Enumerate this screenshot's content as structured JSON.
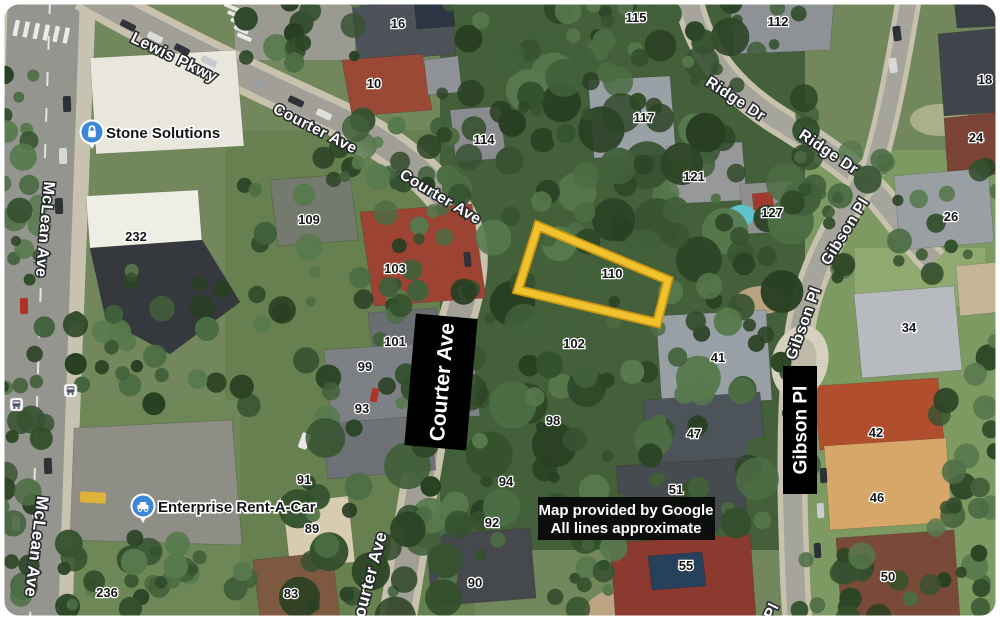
{
  "map": {
    "attribution": {
      "line1": "Map provided by Google",
      "line2": "All lines approximate"
    },
    "businesses": [
      {
        "name": "Stone Solutions",
        "icon": "lock-pin-icon"
      },
      {
        "name": "Enterprise Rent-A-Car",
        "icon": "car-pin-icon"
      }
    ],
    "overlay_boxes": [
      {
        "text": "Courter Ave"
      },
      {
        "text": "Gibson Pl"
      }
    ],
    "parcel": {
      "label": "110",
      "outline_color": "#F0C22E"
    },
    "icons": [
      "lock-pin-icon",
      "car-pin-icon",
      "bus-stop-icon",
      "bus-stop-icon"
    ],
    "colors": {
      "parcel_outline": "#F0C22E",
      "pin_blue": "#3D87D6",
      "annotation_bg": "#000000"
    },
    "street_labels": [
      {
        "t": "Lewis Pkwy",
        "x": 172,
        "y": 62,
        "r": 26,
        "s": 16
      },
      {
        "t": "Courter Ave",
        "x": 313,
        "y": 133,
        "r": 27,
        "s": 15.5
      },
      {
        "t": "Courter Ave",
        "x": 438,
        "y": 201,
        "r": 31,
        "s": 15.5
      },
      {
        "t": "Courter Ave",
        "x": 374,
        "y": 582,
        "r": -75,
        "s": 17
      },
      {
        "t": "McLean Ave",
        "x": 40,
        "y": 229,
        "r": 95,
        "s": 16
      },
      {
        "t": "McLean Ave",
        "x": 31,
        "y": 546,
        "r": 97,
        "s": 17
      },
      {
        "t": "Ridge Dr",
        "x": 733,
        "y": 103,
        "r": 33,
        "s": 15.5
      },
      {
        "t": "Ridge Dr",
        "x": 826,
        "y": 156,
        "r": 34,
        "s": 15.5
      },
      {
        "t": "Gibson Pl",
        "x": 849,
        "y": 234,
        "r": -58,
        "s": 15.5
      },
      {
        "t": "Gibson Pl",
        "x": 808,
        "y": 325,
        "r": -70,
        "s": 15.5
      },
      {
        "t": "Pl",
        "x": 776,
        "y": 613,
        "r": -65,
        "s": 15.5
      }
    ],
    "house_numbers": [
      {
        "t": "16",
        "x": 398,
        "y": 28
      },
      {
        "t": "10",
        "x": 374,
        "y": 88
      },
      {
        "t": "115",
        "x": 636,
        "y": 22
      },
      {
        "t": "112",
        "x": 778,
        "y": 26
      },
      {
        "t": "114",
        "x": 484,
        "y": 144
      },
      {
        "t": "117",
        "x": 644,
        "y": 122
      },
      {
        "t": "121",
        "x": 694,
        "y": 181
      },
      {
        "t": "127",
        "x": 772,
        "y": 217
      },
      {
        "t": "18",
        "x": 985,
        "y": 84
      },
      {
        "t": "24",
        "x": 976,
        "y": 142
      },
      {
        "t": "26",
        "x": 951,
        "y": 221
      },
      {
        "t": "232",
        "x": 136,
        "y": 241
      },
      {
        "t": "109",
        "x": 309,
        "y": 224
      },
      {
        "t": "103",
        "x": 395,
        "y": 273
      },
      {
        "t": "101",
        "x": 395,
        "y": 346
      },
      {
        "t": "99",
        "x": 365,
        "y": 371
      },
      {
        "t": "93",
        "x": 362,
        "y": 413
      },
      {
        "t": "91",
        "x": 304,
        "y": 484
      },
      {
        "t": "89",
        "x": 312,
        "y": 533
      },
      {
        "t": "83",
        "x": 291,
        "y": 598
      },
      {
        "t": "236",
        "x": 107,
        "y": 597
      },
      {
        "t": "110",
        "x": 612,
        "y": 278
      },
      {
        "t": "102",
        "x": 574,
        "y": 348
      },
      {
        "t": "98",
        "x": 553,
        "y": 425
      },
      {
        "t": "94",
        "x": 506,
        "y": 486
      },
      {
        "t": "92",
        "x": 492,
        "y": 527
      },
      {
        "t": "90",
        "x": 475,
        "y": 587
      },
      {
        "t": "41",
        "x": 718,
        "y": 362
      },
      {
        "t": "47",
        "x": 694,
        "y": 438
      },
      {
        "t": "51",
        "x": 676,
        "y": 494
      },
      {
        "t": "55",
        "x": 686,
        "y": 570
      },
      {
        "t": "34",
        "x": 909,
        "y": 332
      },
      {
        "t": "42",
        "x": 876,
        "y": 437
      },
      {
        "t": "46",
        "x": 877,
        "y": 502
      },
      {
        "t": "50",
        "x": 888,
        "y": 581
      }
    ]
  }
}
